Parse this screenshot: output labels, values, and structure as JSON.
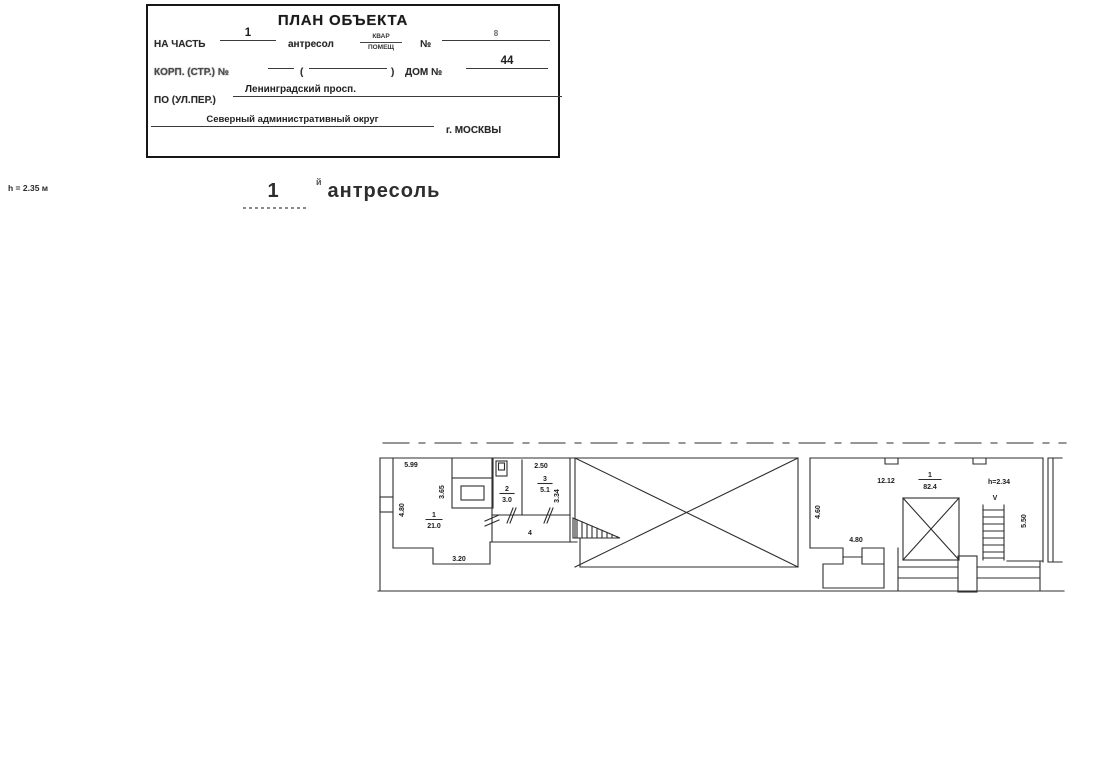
{
  "title_block": {
    "title": "ПЛАН ОБЪЕКТА",
    "row1": {
      "label": "НА ЧАСТЬ",
      "part_value": "1",
      "type_label": "антресол",
      "frac_top": "КВАР",
      "frac_bottom": "ПОМЕЩ",
      "number_label": "№",
      "number_value": "8"
    },
    "row2": {
      "label": "КОРП. (СТР.) №",
      "paren_open": "(",
      "paren_close": ")",
      "house_label": "ДОМ №",
      "house_value": "44"
    },
    "row3": {
      "label": "ПО (УЛ.ПЕР.)",
      "street_value": "Ленинградский просп."
    },
    "row4": {
      "district": "Северный административный округ",
      "city": "г. МОСКВЫ"
    }
  },
  "margin_note": {
    "height": "h = 2.35 м"
  },
  "heading": {
    "number": "1",
    "suffix": "й",
    "title": "антресоль"
  },
  "plan": {
    "left_unit": {
      "room1": {
        "number": "1",
        "area": "21.0",
        "dim_top": "5.99",
        "dim_left": "4.80",
        "dim_mid": "3.65",
        "dim_bottom": "3.20"
      },
      "room2": {
        "number": "2",
        "area": "3.0"
      },
      "room3": {
        "number": "3",
        "area": "5.1",
        "dim_top": "2.50",
        "dim_right": "3.34"
      },
      "corridor": {
        "number": "4"
      }
    },
    "right_unit": {
      "room1": {
        "number": "1",
        "area": "82.4",
        "dim_top": "12.12"
      },
      "dim_left": "4.60",
      "dim_inner": "4.80",
      "dim_right": "5.50",
      "height_note": "h=2.34",
      "stair_mark": "V"
    }
  }
}
